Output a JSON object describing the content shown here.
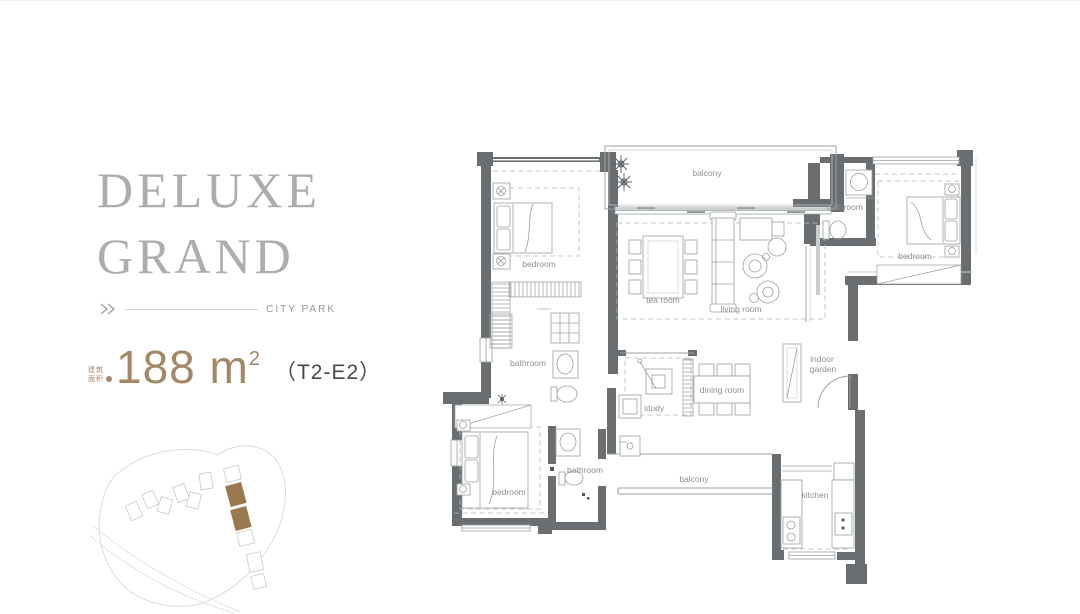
{
  "panel": {
    "title_line1": "DELUXE",
    "title_line2": "GRAND",
    "tagline": "CITY PARK",
    "area_tag_line1": "建筑",
    "area_tag_line2": "面积",
    "area_value": "188",
    "area_unit": " m",
    "area_sup": "2",
    "unit_code": "（T2-E2）"
  },
  "floorplan": {
    "rooms": [
      {
        "id": "balcony-top",
        "label": "balcony"
      },
      {
        "id": "bathroom-top-right",
        "label": "bathroom"
      },
      {
        "id": "bedroom-top-right",
        "label": "bedroom"
      },
      {
        "id": "bedroom-top-left",
        "label": "bedroom"
      },
      {
        "id": "tea-room",
        "label": "tea room"
      },
      {
        "id": "living-room",
        "label": "living room"
      },
      {
        "id": "bathroom-mid-left",
        "label": "bathroom"
      },
      {
        "id": "indoor-garden",
        "label": "indoor garden",
        "line1": "indoor",
        "line2": "garden"
      },
      {
        "id": "study",
        "label": "study"
      },
      {
        "id": "dining-room",
        "label": "dining room"
      },
      {
        "id": "bedroom-bottom-left",
        "label": "bedroom"
      },
      {
        "id": "bathroom-bottom",
        "label": "bathroom"
      },
      {
        "id": "balcony-bottom",
        "label": "balcony"
      },
      {
        "id": "kitchen",
        "label": "kitchen"
      }
    ]
  },
  "colors": {
    "title": "#abadaf",
    "tagline": "#96989a",
    "area_accent": "#a28867",
    "unit_code": "#45474a",
    "wall": "#6a6e70",
    "furniture_line": "#9aa0a2",
    "room_label": "#8b8f92",
    "siteplan_outline": "#dadcdd",
    "siteplan_highlight": "#9b7950"
  }
}
